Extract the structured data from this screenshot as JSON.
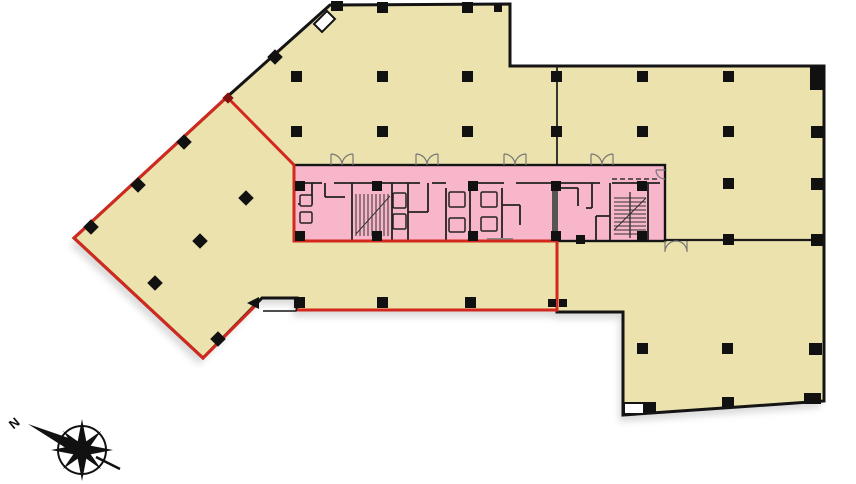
{
  "diagram": {
    "type": "building-floor-plan",
    "compass": {
      "label": "N"
    },
    "colors": {
      "floor": "#ECE2AD",
      "core": "#F8B6CA",
      "boundary": "#D2281E",
      "outline": "#141414",
      "innerwall": "#222222",
      "doorarc": "#777777"
    },
    "regions": [
      {
        "id": "west-wing",
        "name": "west-wing-red-outlined-area"
      },
      {
        "id": "central-core",
        "name": "pink-service-core"
      },
      {
        "id": "north-plate",
        "name": "upper-floor-plate"
      },
      {
        "id": "southeast-plate",
        "name": "lower-right-floor-plate"
      }
    ]
  }
}
